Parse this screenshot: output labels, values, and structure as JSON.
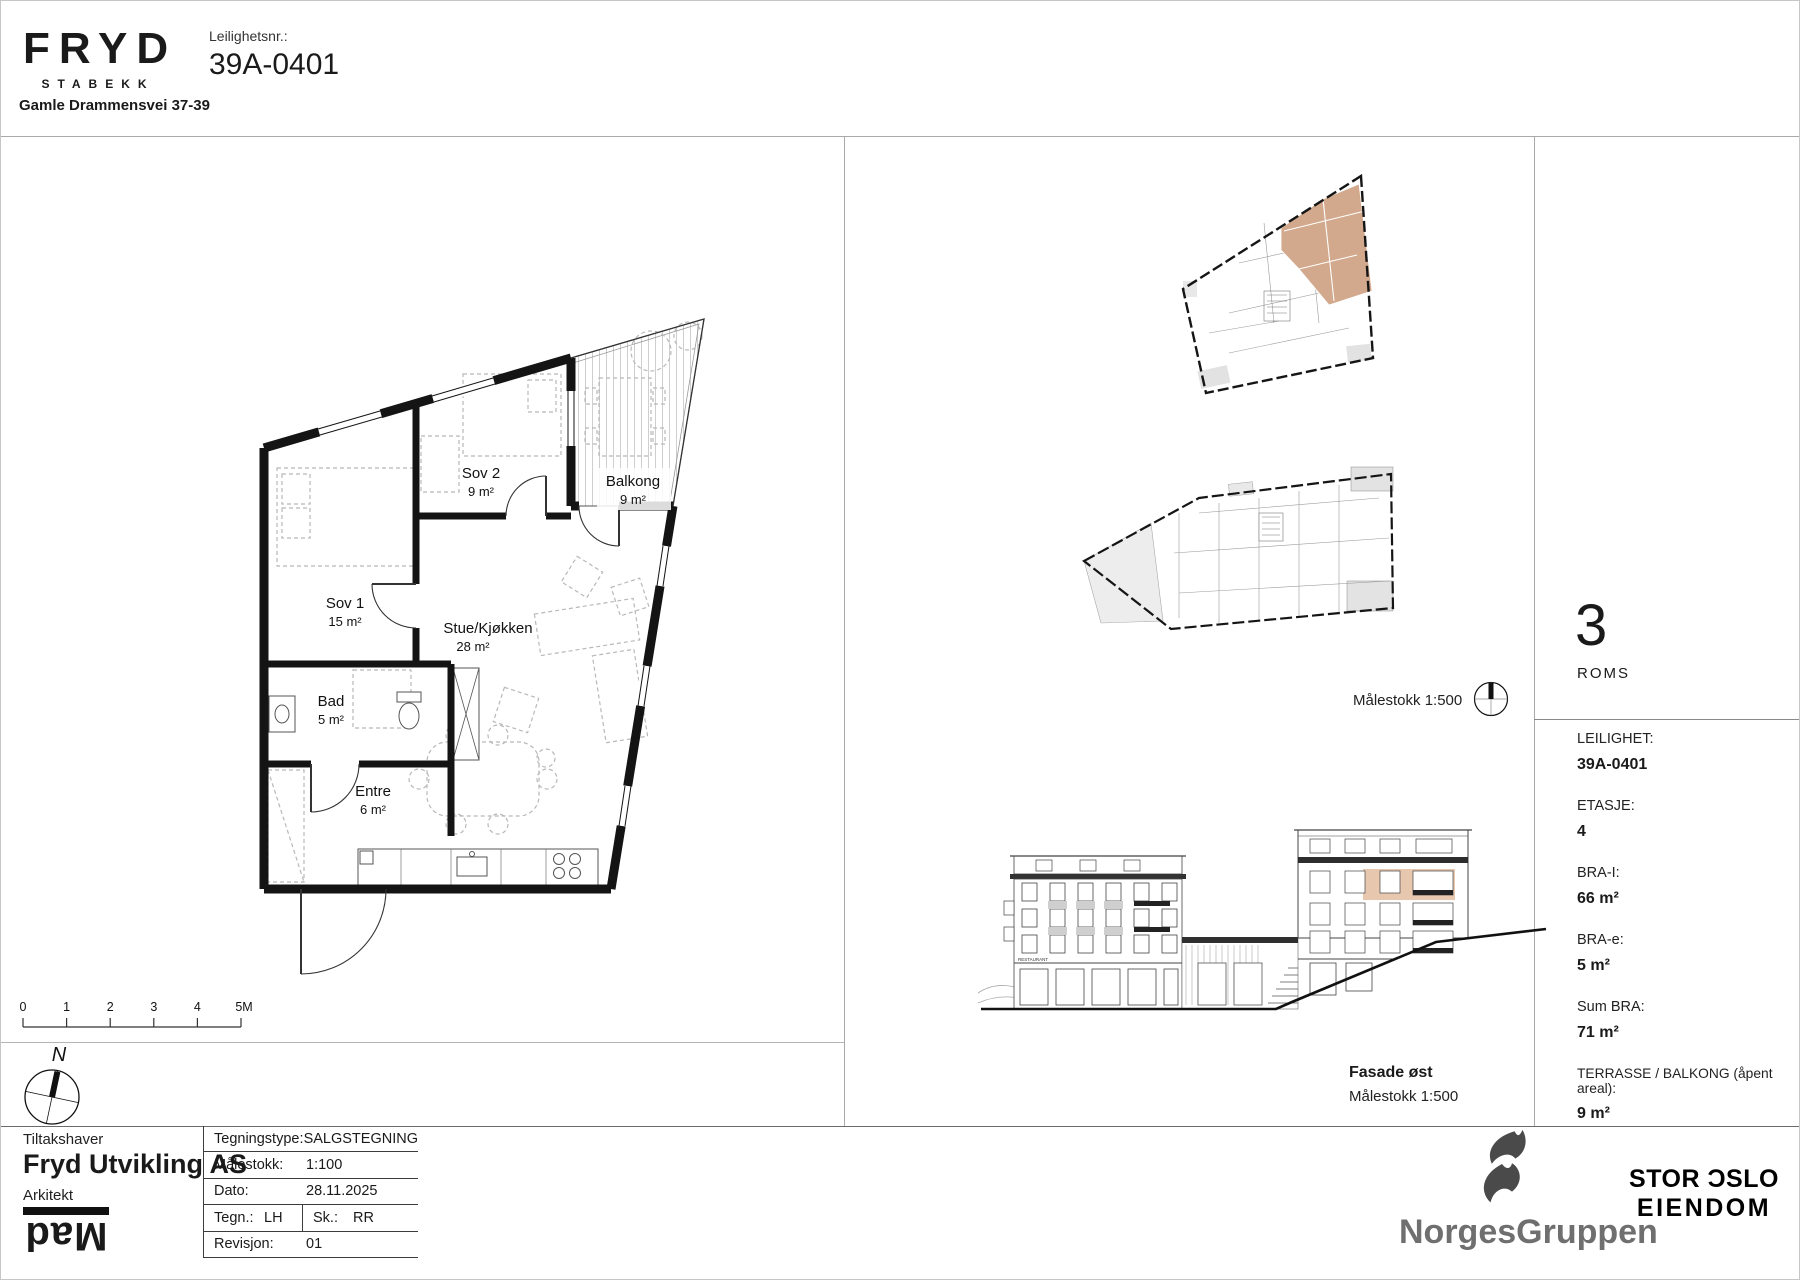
{
  "header": {
    "brand": "FRYD",
    "brand_sub": "STABEKK",
    "address": "Gamle Drammensvei 37-39",
    "apartment_label": "Leilighetsnr.:",
    "apartment_number": "39A-0401"
  },
  "floorplan": {
    "rooms": [
      {
        "name": "Sov 2",
        "area": "9 m²"
      },
      {
        "name": "Balkong",
        "area": "9 m²"
      },
      {
        "name": "Sov 1",
        "area": "15 m²"
      },
      {
        "name": "Stue/Kjøkken",
        "area": "28 m²"
      },
      {
        "name": "Bad",
        "area": "5 m²"
      },
      {
        "name": "Entre",
        "area": "6 m²"
      }
    ],
    "scalebar": [
      "0",
      "1",
      "2",
      "3",
      "4",
      "5M"
    ],
    "north_label": "N"
  },
  "middle": {
    "keyplan_scale": "Målestokk 1:500",
    "elevation_title": "Fasade øst",
    "elevation_scale": "Målestokk 1:500",
    "restaurant_sign": "RESTAURANT"
  },
  "summary": {
    "rooms_count": "3",
    "rooms_label": "ROMS",
    "fields": [
      {
        "label": "LEILIGHET:",
        "value": "39A-0401"
      },
      {
        "label": "ETASJE:",
        "value": "4"
      },
      {
        "label": "BRA-I:",
        "value": "66 m²"
      },
      {
        "label": "BRA-e:",
        "value": "5 m²"
      },
      {
        "label": "Sum BRA:",
        "value": "71 m²"
      },
      {
        "label": "TERRASSE / BALKONG (åpent areal):",
        "value": "9 m²"
      }
    ]
  },
  "titleblock": {
    "owner_label": "Tiltakshaver",
    "owner": "Fryd Utvikling AS",
    "architect_label": "Arkitekt",
    "architect_logo": "Mad",
    "rows": [
      {
        "label": "Tegningstype:",
        "value": "SALGSTEGNING"
      },
      {
        "label": "Målestokk:",
        "value": "1:100"
      },
      {
        "label": "Dato:",
        "value": "28.11.2025"
      },
      {
        "label": "Tegn.:",
        "value": "LH",
        "label2": "Sk.:",
        "value2": "RR"
      },
      {
        "label": "Revisjon:",
        "value": "01"
      }
    ]
  },
  "footer": {
    "norgesgruppen": "NorgesGruppen",
    "storoslo_line1": "STOR ƆSLO",
    "storoslo_line2": "EIENDOM"
  },
  "colors": {
    "highlight_tan": "#d2a98c",
    "elevation_highlight": "#dfb190"
  }
}
